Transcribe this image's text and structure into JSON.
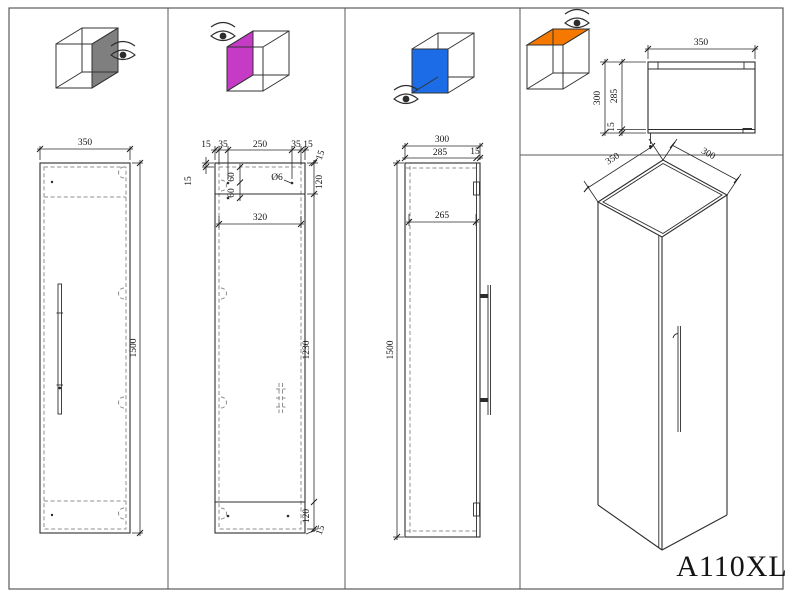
{
  "model": "A110XL",
  "palette": {
    "face_gray": "#7f7f7f",
    "face_magenta": "#c63bc6",
    "face_blue": "#1b6ce6",
    "face_orange": "#f57900",
    "line": "#2d2d2d"
  },
  "panels": {
    "front_view": {
      "width": "350",
      "height": "1500"
    },
    "drilling_view": {
      "top_chain": [
        "15",
        "35",
        "250",
        "35",
        "15"
      ],
      "top_right": "15",
      "left_top": "15",
      "hole_rows": [
        "60",
        "60"
      ],
      "hole_diameter": "Ø6",
      "top_offset": "120",
      "inner_width": "320",
      "mid_height": "1230",
      "bottom_offset": "120",
      "bottom_right": "15"
    },
    "side_view": {
      "depth": "300",
      "body": "285",
      "door": "15",
      "inner_depth": "265",
      "height": "1500"
    },
    "top_view": {
      "width": "350",
      "depth": "300",
      "body": "285",
      "door": "15"
    },
    "iso_view": {
      "width": "350",
      "depth": "300"
    }
  }
}
